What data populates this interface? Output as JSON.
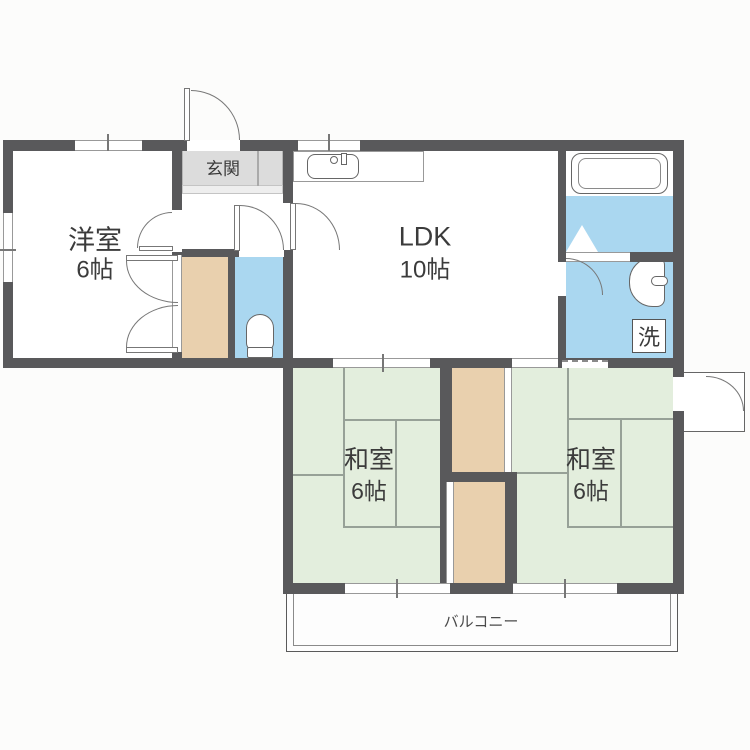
{
  "plan": {
    "type": "apartment-floor-plan",
    "labels": {
      "genkan": "玄関",
      "yoshitsu": {
        "name": "洋室",
        "size": "6帖"
      },
      "ldk": {
        "name": "LDK",
        "size": "10帖"
      },
      "washitsu_left": {
        "name": "和室",
        "size": "6帖"
      },
      "washitsu_right": {
        "name": "和室",
        "size": "6帖"
      },
      "laundry": "洗",
      "balcony": "バルコニー"
    },
    "palette": {
      "wall": "#59595b",
      "water_blue": "#aad7f0",
      "closet_tan": "#e9d0ae",
      "tatami_green": "#e3eedd",
      "genkan_gray": "#dcdcdc",
      "fixture_line": "#777777"
    },
    "fixtures": [
      "bathtub",
      "kitchen-sink",
      "toilet",
      "washbasin",
      "washing-machine-space",
      "folding-bath-door",
      "balcony"
    ]
  }
}
